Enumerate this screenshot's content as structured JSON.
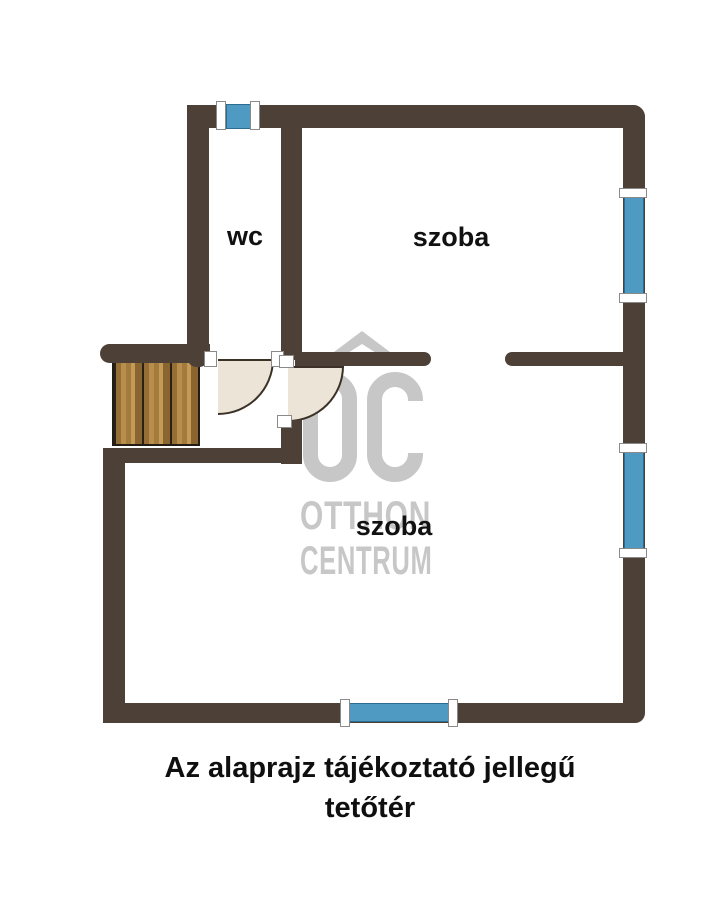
{
  "floorplan": {
    "rooms": {
      "wc_label": "wc",
      "room_top_label": "szoba",
      "room_bottom_label": "szoba"
    },
    "caption": {
      "line1": "Az alaprajz tájékoztató jellegű",
      "line2": "tetőtér"
    },
    "watermark": {
      "brand_line1": "OTTHON",
      "brand_line2": "CENTRUM",
      "monogram": "OC",
      "roof_icon": "roof-icon"
    },
    "colors": {
      "wall": "#4c4037",
      "window_glass": "#4e9ac2",
      "door_leaf": "#ece5d7",
      "stairs_wood": "#a37b3c",
      "watermark_gray": "#c7c7c7",
      "label_text": "#111111"
    }
  }
}
